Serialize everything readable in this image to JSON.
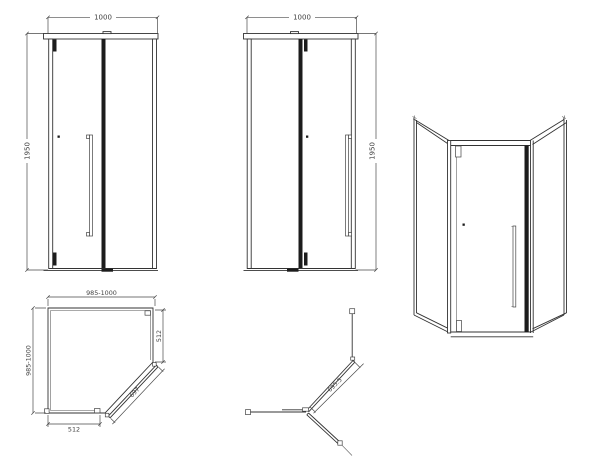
{
  "drawing": {
    "title": "pentagon-shower-enclosure-technical-drawing",
    "colors": {
      "background": "#ffffff",
      "line": "#333333",
      "dim_text": "#414141",
      "dark_profile": "#1c1c1c"
    },
    "views": {
      "front_door_left": {
        "width_label": "1000",
        "height_label": "1950"
      },
      "front_door_right": {
        "width_label": "1000",
        "height_label": "1950"
      },
      "plan": {
        "width_label": "985-1000",
        "depth_label": "985-1000",
        "right_side_label": "512",
        "bottom_side_label": "512",
        "door_diagonal_label": "697"
      },
      "door_swing": {
        "door_width_label": "695.5"
      }
    }
  }
}
